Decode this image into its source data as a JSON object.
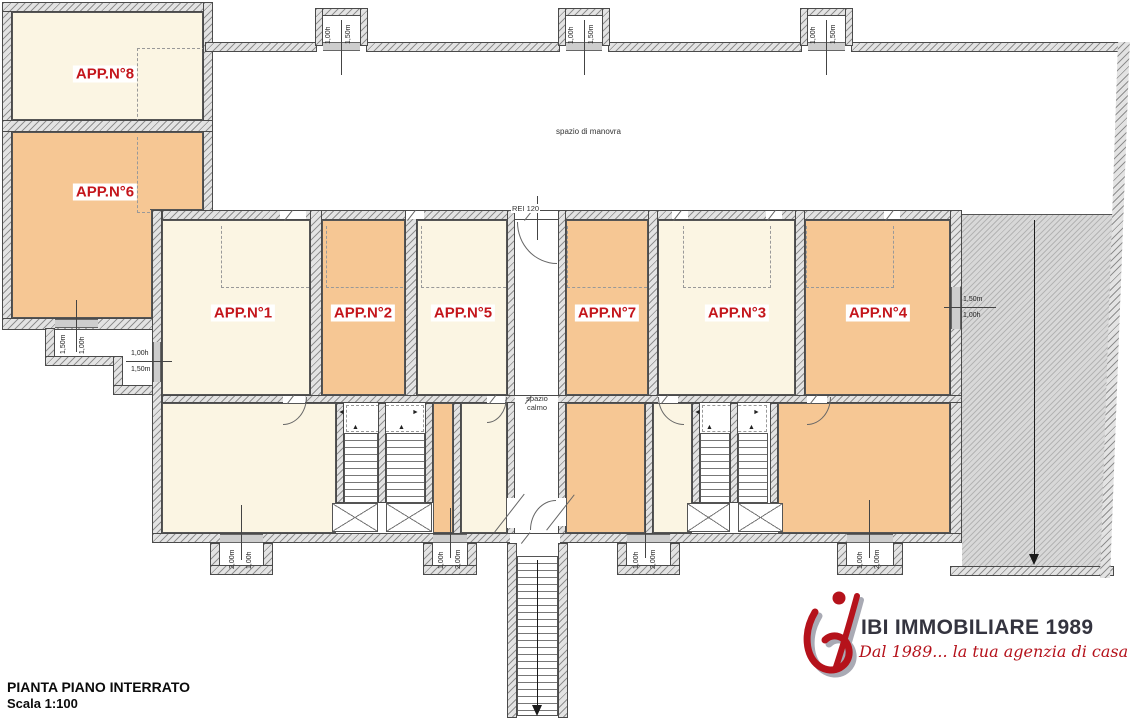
{
  "plan": {
    "title": "PIANTA PIANO INTERRATO",
    "scale": "Scala 1:100"
  },
  "rooms": {
    "app1": "APP.N°1",
    "app2": "APP.N°2",
    "app3": "APP.N°3",
    "app4": "APP.N°4",
    "app5": "APP.N°5",
    "app6": "APP.N°6",
    "app7": "APP.N°7",
    "app8": "APP.N°8"
  },
  "zones": {
    "manovra": "spazio di manovra",
    "calmo": "spazio calmo",
    "rei": "REI 120"
  },
  "dims": {
    "h100": "1,00h",
    "m150": "1,50m",
    "m200": "2,00m"
  },
  "icons": {
    "arrow_left": "◄",
    "arrow_right": "►",
    "arrow_up": "▲"
  },
  "logo": {
    "name": "IBI IMMOBILIARE 1989",
    "tagline": "Dal 1989... la tua agenzia di casa"
  },
  "colors": {
    "room_cream": "#FBF5E3",
    "room_orange": "#F6C794",
    "label_red": "#C4161C",
    "logo_red": "#B5121B",
    "logo_text": "#34343F",
    "ramp_gray": "#D8D8D8"
  }
}
